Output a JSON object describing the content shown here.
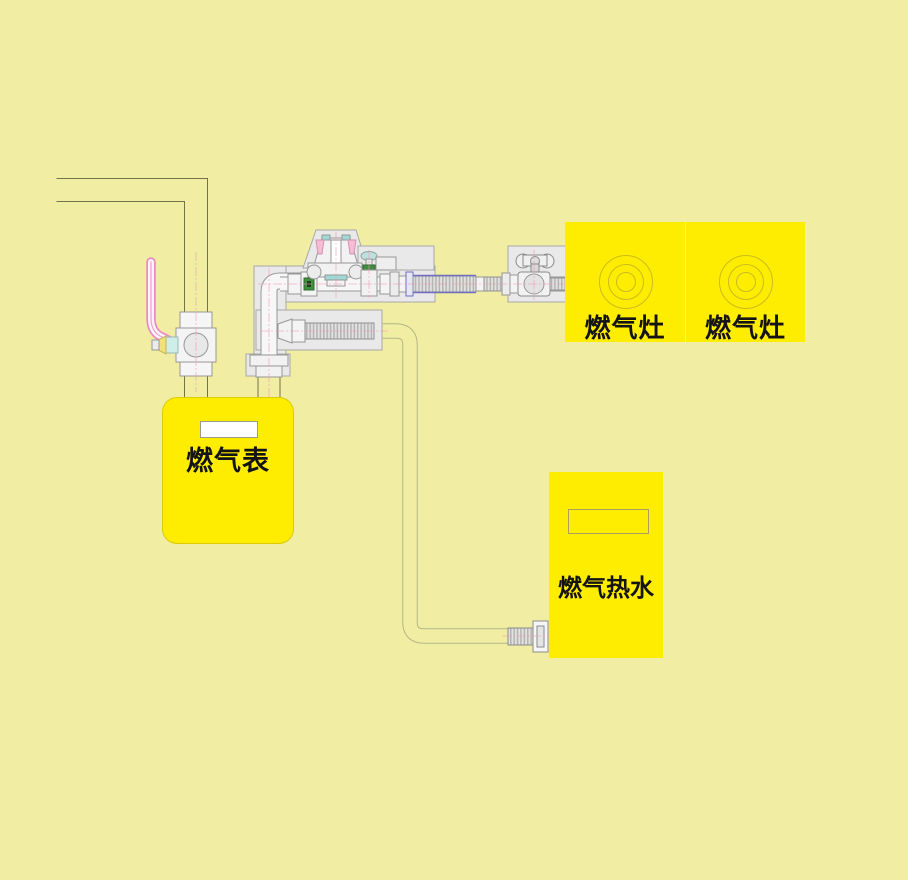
{
  "diagram_title": "gas-piping-installation-diagram",
  "labels": {
    "meter": "燃气表",
    "stove_left": "燃气灶",
    "stove_right": "燃气灶",
    "heater": "燃气热水"
  },
  "components": [
    "wall-supply-riser",
    "meter-shutoff-valve",
    "gas-meter",
    "outlet-elbow-pipe",
    "pressure-regulator",
    "branch-shutoff-valve",
    "upper-flex-hose",
    "stove-shutoff-valve",
    "gas-stove-left",
    "gas-stove-right",
    "lower-flex-hose",
    "heater-supply-pipe",
    "heater-connector",
    "gas-water-heater"
  ],
  "colors": {
    "background": "#f1eea3",
    "appliance_yellow": "#ffed00",
    "valve_handle_pink": "#e98cc4",
    "hose_edge_blue": "#7070bb",
    "mount_plate_gray": "#e9e9e9",
    "wall_line_olive": "#72724d",
    "thin_pipe_tan": "#b6b687",
    "fitting_green": "#3f8f3f",
    "fitting_teal": "#9fd8d4"
  }
}
